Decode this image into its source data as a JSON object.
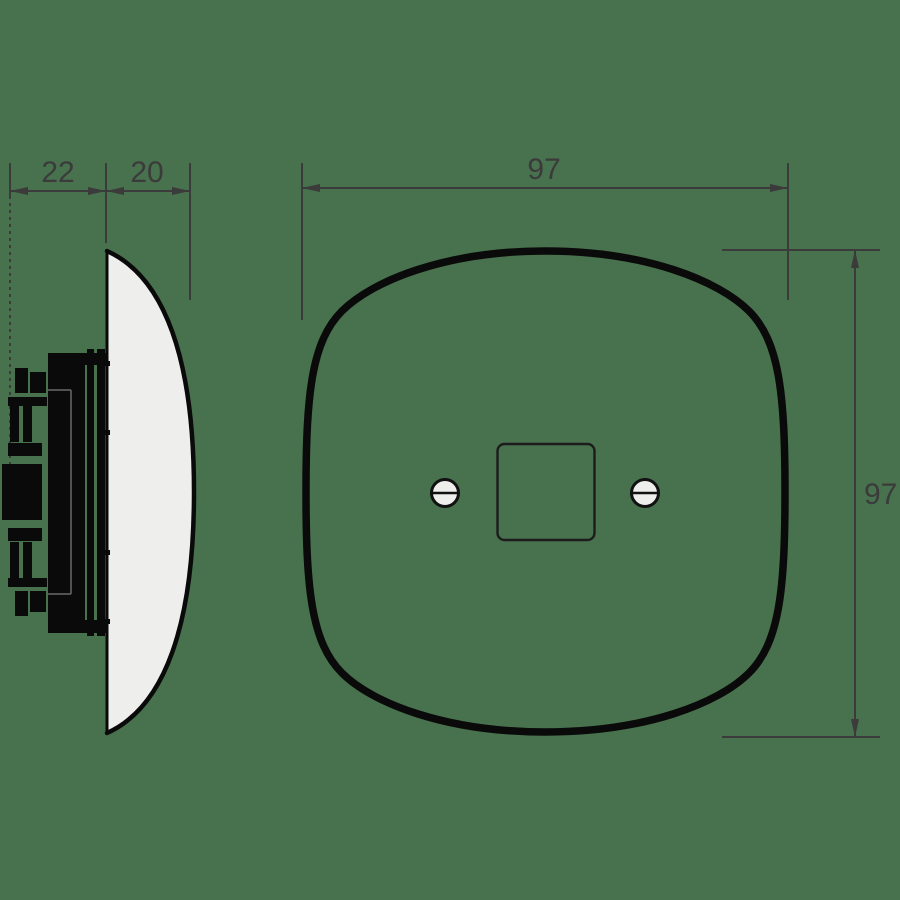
{
  "drawing": {
    "kind": "technical-drawing",
    "subject": "rounded square wall switch plate, side profile and front view",
    "dimensions": {
      "side_depth_back": "22",
      "side_depth_plate": "20",
      "front_width": "97",
      "front_height": "97"
    },
    "colors": {
      "background": "#48714E",
      "dimension_lines": "#3b3b3b",
      "plate_fill": "#eeeeec",
      "outline_black": "#0a0a0a"
    }
  }
}
